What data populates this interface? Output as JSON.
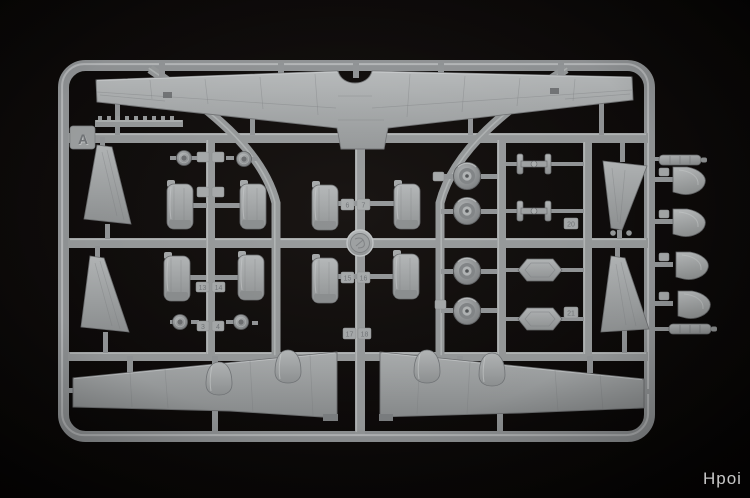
{
  "image_type": "photograph",
  "subject": "Grey injection-moulded plastic model-kit sprue (parts runner) of an aircraft kit, photographed on a black background",
  "colors": {
    "background": "#0b0908",
    "plastic": "#9a9d9e",
    "plastic_highlight": "#c6c9ca",
    "plastic_shadow": "#55575a",
    "watermark": "#d9d9d9"
  },
  "sprue": {
    "letter": "A",
    "tags": {
      "n3": "3",
      "n4": "4",
      "n6": "6",
      "n7": "7",
      "n13": "13",
      "n14": "14",
      "n15": "15",
      "n16": "16",
      "n17": "17",
      "n18": "18",
      "n20": "20",
      "n21": "21"
    },
    "parts": [
      {
        "name": "upper-wing",
        "qty": 1
      },
      {
        "name": "lower-wing-half",
        "qty": 2
      },
      {
        "name": "engine-nacelle-half",
        "qty": 8
      },
      {
        "name": "main-wheel",
        "qty": 4
      },
      {
        "name": "wheel-hub",
        "qty": 4
      },
      {
        "name": "fin-half",
        "qty": 4
      },
      {
        "name": "gear-brace",
        "qty": 2
      },
      {
        "name": "hexagonal-hatch",
        "qty": 2
      },
      {
        "name": "dome-fairing",
        "qty": 4
      },
      {
        "name": "small-rod",
        "qty": 2
      },
      {
        "name": "gear-pod-fairing",
        "qty": 4
      }
    ],
    "maker_logo": "circular embossed medallion at sprue centre"
  },
  "watermark": {
    "text": "Hpoi"
  }
}
